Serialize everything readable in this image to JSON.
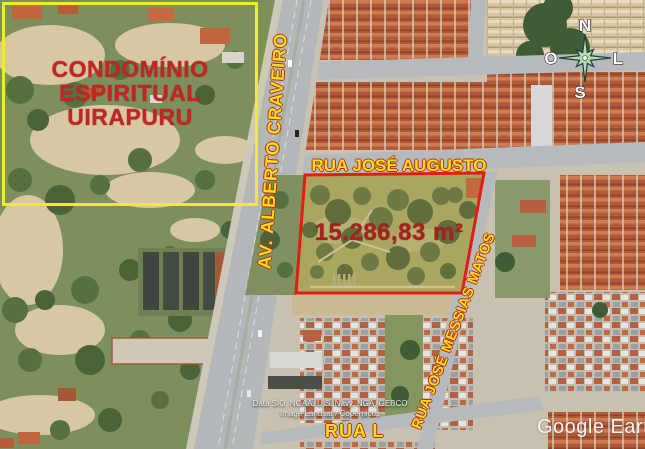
{
  "colors": {
    "highlight_box_yellow": "#f0ec2d",
    "street_label_yellow": "#ffdd1c",
    "annotation_red": "#c32522",
    "parcel_outline_red": "#e21d12"
  },
  "map": {
    "condominio_box": {
      "line1": "CONDOMÍNIO",
      "line2": "ESPIRITUAL",
      "line3": "UIRAPURU"
    },
    "parcel": {
      "area_label": "15.286,83 m²"
    },
    "streets": {
      "avenue": "AV. ALBERTO CRAVEIRO",
      "north_street": "RUA JOSÉ AUGUSTO",
      "east_street": "RUA JOSÉ MESSIAS MATOS",
      "south_street": "RUA L"
    },
    "compass": {
      "north": "N",
      "south": "S",
      "west": "O",
      "east": "L"
    },
    "attribution": {
      "line1": "Data SIO, NOAA, U.S. Navy, NGA, GEBCO",
      "line2": "Image Landsat / Copernicus"
    },
    "watermark": "Google Earth"
  }
}
